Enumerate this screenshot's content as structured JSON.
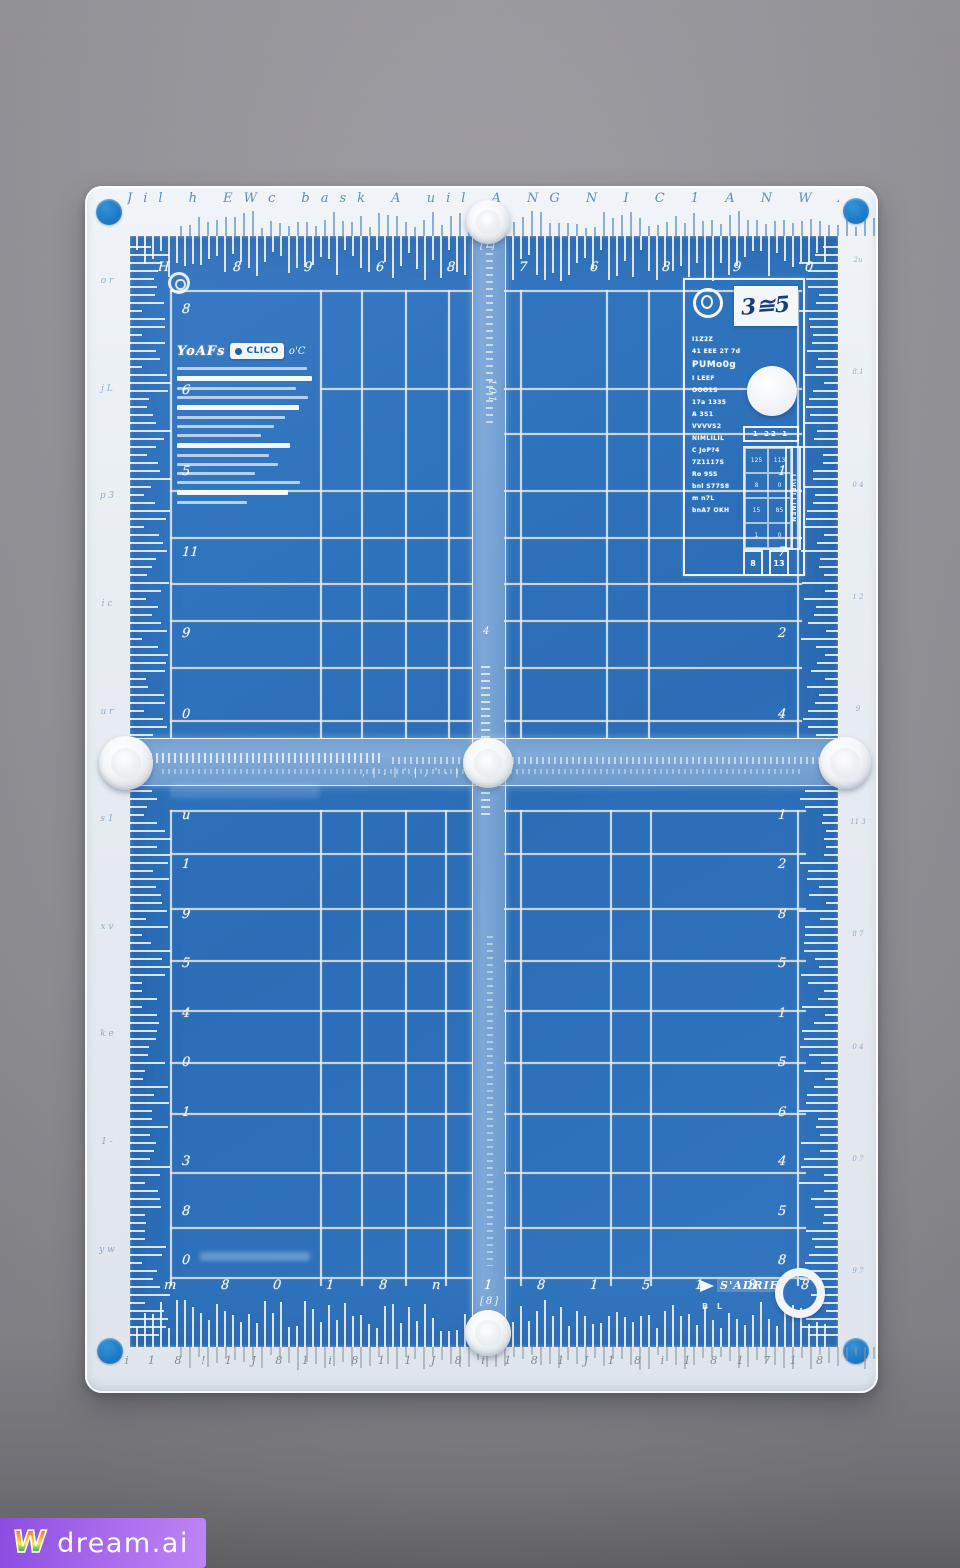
{
  "scene": {
    "background_gray": "#9b9aa0",
    "watermark": {
      "logo_glyph": "W",
      "brand": "dream.ai",
      "bg_left": "#8a4de0",
      "bg_right": "#bd85f4"
    }
  },
  "mat": {
    "colors": {
      "blue": "#2e72bc",
      "border_white": "#e8edf2",
      "corner_dot_blue": "#1f7ac6",
      "grid_line": "#f5f2e8"
    },
    "top_left_panel": {
      "brand": "YoAFs",
      "pill_text": "CLICO",
      "corner_mark": "o'C",
      "line_widths": [
        96,
        100,
        88,
        97,
        90,
        80,
        72,
        62,
        84,
        68,
        75,
        58,
        91,
        82,
        52
      ],
      "bright_lines": [
        1,
        4,
        8,
        13
      ]
    },
    "top_right_panel": {
      "tag_number": "3≅5",
      "tokens": [
        "I1Z2Z",
        "41 EEE 2T 7d",
        "PUMo0g",
        "I LEEF",
        "OOO1S",
        "17a 1335",
        "A 3S1",
        "VVVVS2",
        "NIMLILIL",
        "C JoP?4",
        "7Z1117S",
        "Ro 9SS",
        "bnl S77S8",
        "m n7L",
        "bnA7 OKH"
      ],
      "big_token_index": 2,
      "widebox_text": "1 22 1",
      "ladder_cells": [
        "125",
        "113",
        "8",
        "0",
        "15",
        "85",
        "1",
        "0"
      ],
      "tallbox_text": "LIVELLINEN",
      "minibox_a": "8",
      "minibox_b": "13"
    },
    "bottom_logo": {
      "text": "S'ADRIE",
      "tag": "B L"
    },
    "ruler_numbers": {
      "top": [
        "H",
        "8",
        "9",
        "6",
        "8",
        "7",
        "6",
        "8",
        "9",
        "0"
      ],
      "bottom": [
        "m",
        "8",
        "0",
        "1",
        "8",
        "n",
        "1",
        "8",
        "1",
        "5",
        "1",
        "3",
        "8"
      ],
      "left_top": [
        "8",
        "6",
        "5",
        "11",
        "9",
        "0"
      ],
      "left_bottom": [
        "u",
        "1",
        "9",
        "5",
        "4",
        "0",
        "1",
        "3",
        "8",
        "0"
      ],
      "right_top": [
        "0",
        "2",
        "1",
        "7",
        "2",
        "4"
      ],
      "right_bottom": [
        "1",
        "2",
        "8",
        "5",
        "1",
        "5",
        "6",
        "4",
        "5",
        "8"
      ]
    },
    "border_glyphs": {
      "top": "Jil h EWc bask A uil A NG N I C 1 A N W A M A N",
      "bottom": "i 1 8 ! 1 J 8 1 i 8 1 1 J 8 i 1 8 1 J 1 8 i 1 8 1 7 1 8",
      "left_blocks": [
        "o r",
        "j L",
        "p 3",
        "i c",
        "u r",
        "s 1",
        "x v",
        "k e",
        "1 -",
        "y w"
      ],
      "right_blocks": [
        "2u",
        "8.1",
        "0 4",
        "1 2",
        "9",
        "11 3",
        "8 7",
        "0 4",
        "0 7",
        "9 7"
      ]
    },
    "vbar_glyphs": [
      "[i]",
      "101",
      "4",
      "[8]"
    ],
    "hbar_glyphs": ", | . |  ' |  , ' ˕ | ,  .  | '  ,",
    "decor": {
      "grid": {
        "top": {
          "left_v": [
            40,
            190,
            231,
            275,
            318
          ],
          "right_v": [
            390,
            476,
            518,
            667
          ],
          "left_h_full": [
            54,
            254,
            301,
            347,
            384,
            431,
            484
          ],
          "left_h_partial": [
            152
          ],
          "right_h": [
            54,
            152,
            197,
            254,
            301,
            347,
            384,
            431,
            484
          ],
          "v_y1": 54,
          "v_y2": 502,
          "left_x1": 40,
          "left_x2": 342,
          "right_x1": 374,
          "right_x2": 672
        },
        "bottom": {
          "left_v": [
            40,
            190,
            231,
            275,
            315
          ],
          "right_v": [
            390,
            480,
            520,
            667
          ],
          "h": [
            574,
            617,
            672,
            724,
            774,
            826,
            877,
            936,
            991,
            1041
          ],
          "v_y1": 574,
          "v_y2": 1050,
          "left_x1": 40,
          "left_x2": 342,
          "right_x1": 374,
          "right_x2": 676
        }
      },
      "combs": {
        "top": {
          "from": 6,
          "to": 700,
          "step": 8,
          "min": 14,
          "max": 46,
          "skip": [
            338,
            378
          ]
        },
        "bottom": {
          "from": 6,
          "to": 700,
          "step": 8,
          "min": 16,
          "max": 48,
          "skip": [
            338,
            378
          ]
        },
        "left": {
          "from": 10,
          "to": 1100,
          "step": 8,
          "min": 12,
          "max": 42,
          "skip": [
            498,
            552
          ]
        },
        "right": {
          "from": 10,
          "to": 1100,
          "step": 8,
          "min": 12,
          "max": 40,
          "skip": [
            498,
            552
          ]
        },
        "top_outer": {
          "from": 50,
          "to": 745,
          "step": 9,
          "min": 8,
          "max": 26
        },
        "bottom_outer": {
          "from": 50,
          "to": 745,
          "step": 9,
          "min": 8,
          "max": 24
        }
      }
    }
  }
}
